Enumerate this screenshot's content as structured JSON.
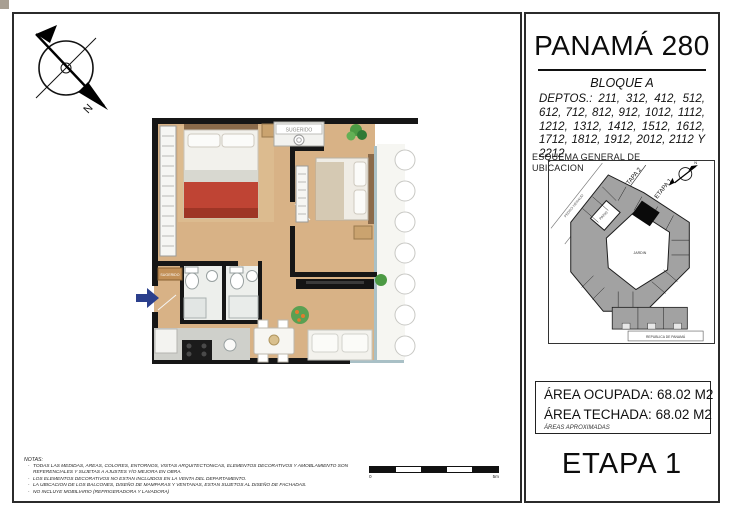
{
  "titleblock": {
    "project": "PANAMÁ 280",
    "block": "BLOQUE A",
    "deptos": "DEPTOS.: 211, 312, 412, 512, 612, 712, 812, 912, 1012, 1112, 1212, 1312, 1412, 1512, 1612, 1712, 1812, 1912, 2012, 2112 Y 2212",
    "etapa": "ETAPA 1"
  },
  "esquema": {
    "title_line1": "ESQUEMA GENERAL DE",
    "title_line2": "UBICACION",
    "street_diagonal": "PEDRO HERAUD",
    "street_bottom": "REPUBLICA DE PANAMÁ",
    "etapa1": "ETAPA 1",
    "etapa2": "ETAPA 2",
    "patio": "PATIO",
    "jardin": "JARDIN",
    "north": "N"
  },
  "areas": {
    "ocupada": {
      "label": "ÁREA OCUPADA:",
      "value": "68.02 M2"
    },
    "techada": {
      "label": "ÁREA TECHADA:",
      "value": "68.02 M2"
    },
    "disclaimer": "ÁREAS APROXIMADAS"
  },
  "plan": {
    "sugerido_top": "SUGERIDO",
    "sugerido_entry": "SUGERIDO"
  },
  "compass": {
    "north": "N"
  },
  "scale_bar": {
    "min": "0",
    "max": "5m"
  },
  "notes": {
    "heading": "NOTAS:",
    "bullet": "-",
    "items": [
      "TODAS LAS MEDIDAS, AREAS, COLORES, ENTORNOS, VISTAS ARQUITECTONICAS, ELEMENTOS DECORATIVOS Y AMOBLAMIENTO SON REFERENCIALES Y SUJETAS A AJUSTES Y/O MEJORA EN OBRA.",
      "LOS ELEMENTOS DECORATIVOS NO ESTAN INCLUIDOS EN LA VENTA DEL DEPARTAMENTO.",
      "LA UBICACION DE LOS BALCONES, DISEÑO DE MAMPARAS Y VENTANAS, ESTAN SUJETOS AL DISEÑO DE FACHADAS.",
      "NO INCLUYE MOBILIARIO (REFRIGERADORA Y LAVADORA)"
    ]
  },
  "colors": {
    "wood_floor": "#d8b286",
    "wall": "#161616",
    "entry_arrow": "#2b3f8c",
    "bed_blanket": "#bf4434",
    "bath_floor": "#edefec",
    "site_building": "#a2a2a2",
    "site_selected_unit": "#0a0a0a"
  }
}
